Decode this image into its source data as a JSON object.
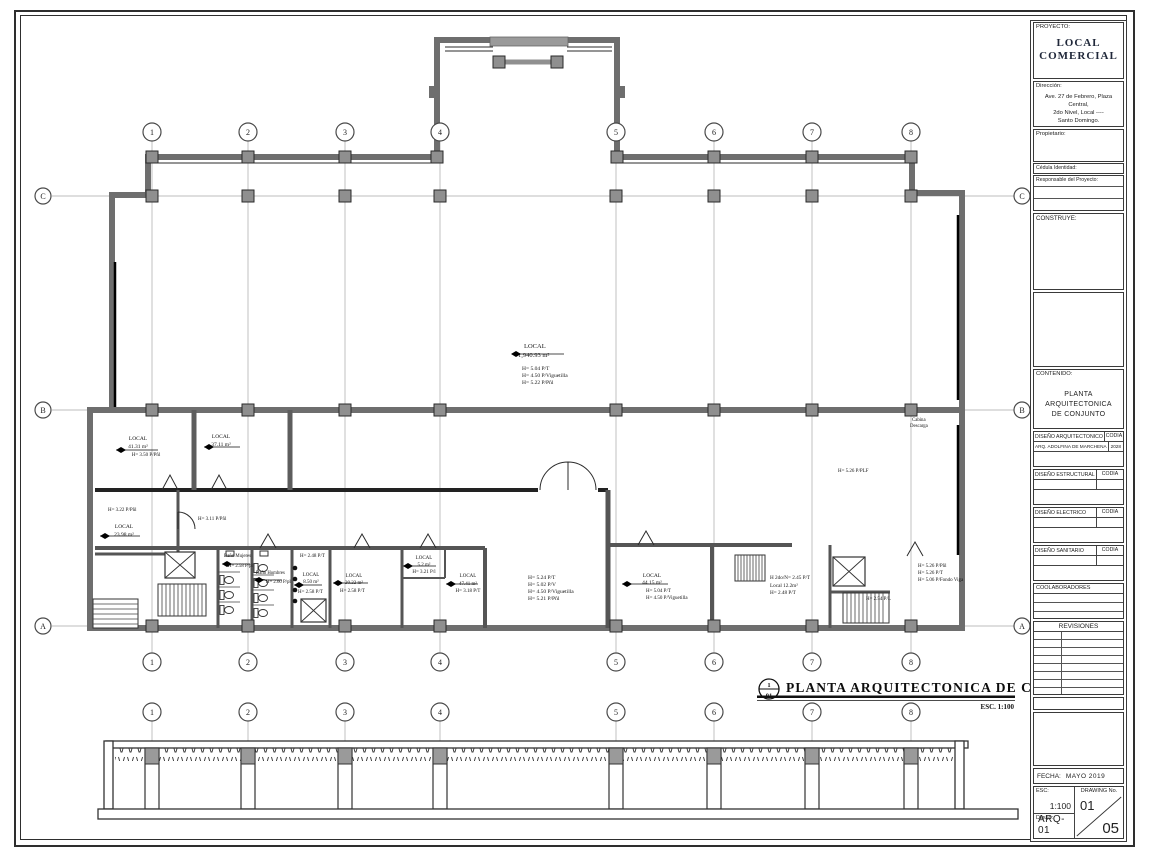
{
  "tb": {
    "proyecto_label": "PROYECTO:",
    "proyecto_line1": "LOCAL",
    "proyecto_line2": "COMERCIAL",
    "direccion_label": "Dirección:",
    "direccion1": "Ave. 27 de Febrero, Plaza Central,",
    "direccion2": "2do Nivel, Local ----",
    "direccion3": "Santo Domingo.",
    "propietario_label": "Propietario:",
    "cedula_label": "Cédula Identidad:",
    "responsable_label": "Responsable del Proyecto:",
    "construye_label": "CONSTRUYE:",
    "contenido_label": "CONTENIDO:",
    "contenido1": "PLANTA ARQUITECTONICA",
    "contenido2": "DE CONJUNTO",
    "codia": "CODIA",
    "arq_label": "DISEÑO ARQUITECTONICO",
    "arq_name": "ARQ. ADOLFINA DE MARCHENA",
    "arq_codia": "2028",
    "estructural_label": "DISEÑO ESTRUCTURAL",
    "electrico_label": "DISEÑO ELECTRICO",
    "sanitario_label": "DISEÑO SANITARIO",
    "colaboradores_label": "COOLABORADORES",
    "revisiones_label": "REVISIONES",
    "fecha_label": "FECHA:",
    "fecha_value": "MAYO 2019",
    "esc_label": "ESC:",
    "esc_value": "1:100",
    "drawing_label": "DRAWING No.",
    "drawing_value": "01",
    "dibujo_label": "Dibujo:",
    "dibujo_value": "ARQ-01",
    "sheet_count": "05"
  },
  "plan": {
    "title": "PLANTA  ARQUITECTONICA  DE  CONJUNTO",
    "scale_label": "ESC. 1:100",
    "ref_top": "1",
    "ref_bottom": "01",
    "grid_cols": [
      "1",
      "2",
      "3",
      "4",
      "5",
      "6",
      "7",
      "8"
    ],
    "grid_rows": [
      "C",
      "B",
      "A"
    ],
    "labels": {
      "main": [
        "LOCAL",
        "1,940.93 m²",
        "H= 5.04 P/T",
        "H= 4.50 P/Viguetilla",
        "H= 5.22 P/Pñl"
      ],
      "l41": [
        "LOCAL",
        "41.31 m²",
        "H= 3.50 P/Pñl"
      ],
      "l37": [
        "LOCAL",
        "37.11 m²"
      ],
      "h322": "H= 3.22 P/Pñl",
      "l23": [
        "LOCAL",
        "23.98 m²"
      ],
      "h311": "H= 3.11 P/Pñl",
      "bano1": "Baño Mujeres",
      "bano1h": "H= 2.58 P/pl",
      "bano2": "Baño Hombres",
      "bano2h": "H= 2.60 P/pl",
      "h248": "H= 2.48 P/T",
      "l850": [
        "LOCAL",
        "8.50 m²",
        "H= 2.58 P/T"
      ],
      "l2022": [
        "LOCAL",
        "20.22 m²",
        "H= 2.58 P/T"
      ],
      "l52": [
        "LOCAL",
        "5.2 m²",
        "H= 3.21 P/l"
      ],
      "l4741": [
        "LOCAL",
        "47.41 m²",
        "H= 3.18 P/T"
      ],
      "mid_heights": [
        "H= 5.24 P/T",
        "H= 5.02 P/V",
        "H= 4.50 P/Viguetilla",
        "H= 5.21 P/Pñl"
      ],
      "l4415": [
        "LOCAL",
        "44.15 m²",
        "H= 5.04 P/T",
        "H= 4.50 P/Viguetilla"
      ],
      "l12": [
        "H 2do/N= 2.45 P/T",
        "Local 12.2m²",
        "H= 2.48 P/T"
      ],
      "h526": "H= 5.26 P/PLF",
      "right_heights": [
        "H= 5.26 P/Pñl",
        "H= 5.26 P/T",
        "H= 5.06 P/Fondo Viga"
      ],
      "h254": "H= 2.54 P/L",
      "cabina1": "Cabina",
      "cabina2": "Descarga"
    }
  }
}
